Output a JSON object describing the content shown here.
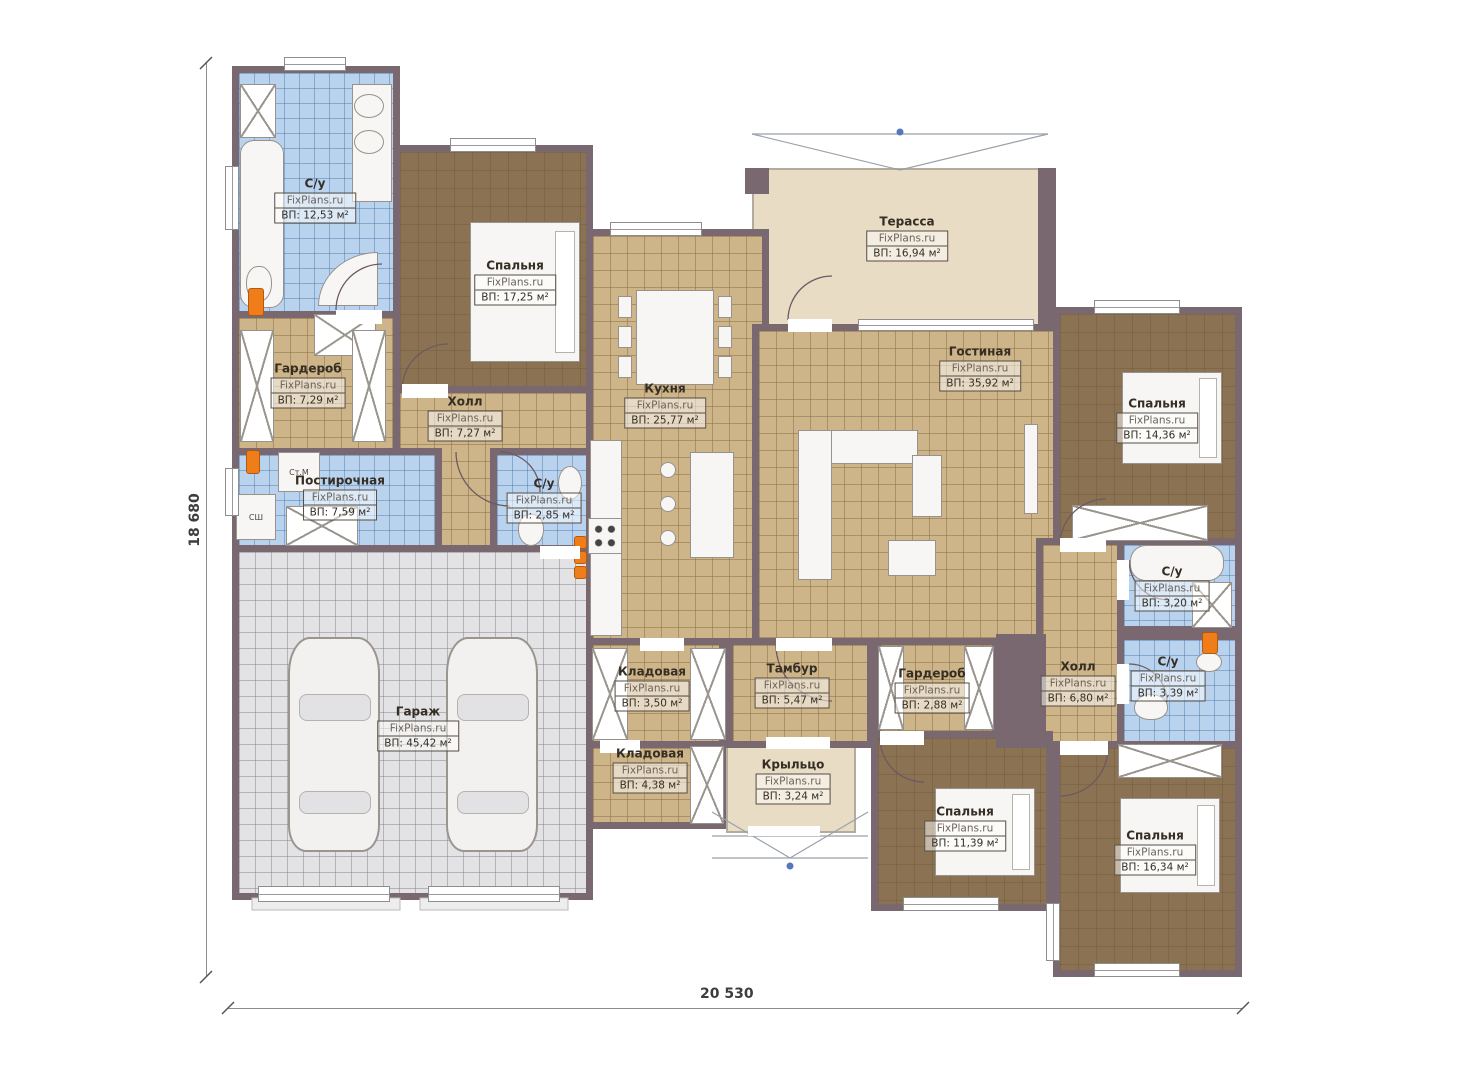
{
  "plan": {
    "watermark": "FixPlans.ru",
    "dimensions": {
      "height": "18 680",
      "width": "20 530"
    },
    "appliances": {
      "washer": "Ст.М",
      "dryer": "СШ"
    },
    "rooms": [
      {
        "id": "bathroom-master",
        "name": "С/у",
        "area": "ВП: 12,53 м²"
      },
      {
        "id": "bedroom-master",
        "name": "Спальня",
        "area": "ВП: 17,25 м²"
      },
      {
        "id": "wardrobe-left",
        "name": "Гардероб",
        "area": "ВП: 7,29 м²"
      },
      {
        "id": "hall-left",
        "name": "Холл",
        "area": "ВП: 7,27 м²"
      },
      {
        "id": "laundry",
        "name": "Постирочная",
        "area": "ВП: 7,59 м²"
      },
      {
        "id": "bathroom-small",
        "name": "С/у",
        "area": "ВП: 2,85 м²"
      },
      {
        "id": "garage",
        "name": "Гараж",
        "area": "ВП: 45,42 м²"
      },
      {
        "id": "kitchen",
        "name": "Кухня",
        "area": "ВП: 25,77 м²"
      },
      {
        "id": "terrace",
        "name": "Терасса",
        "area": "ВП: 16,94 м²"
      },
      {
        "id": "living-room",
        "name": "Гостиная",
        "area": "ВП: 35,92 м²"
      },
      {
        "id": "bedroom-right",
        "name": "Спальня",
        "area": "ВП: 14,36 м²"
      },
      {
        "id": "bathroom-right",
        "name": "С/у",
        "area": "ВП: 3,20 м²"
      },
      {
        "id": "hall-right",
        "name": "Холл",
        "area": "ВП: 6,80 м²"
      },
      {
        "id": "bathroom-right-small",
        "name": "С/у",
        "area": "ВП: 3,39 м²"
      },
      {
        "id": "pantry-top",
        "name": "Кладовая",
        "area": "ВП: 3,50 м²"
      },
      {
        "id": "tambour",
        "name": "Тамбур",
        "area": "ВП: 5,47 м²"
      },
      {
        "id": "wardrobe-bottom",
        "name": "Гардероб",
        "area": "ВП: 2,88 м²"
      },
      {
        "id": "pantry-bottom",
        "name": "Кладовая",
        "area": "ВП: 4,38 м²"
      },
      {
        "id": "porch",
        "name": "Крыльцо",
        "area": "ВП: 3,24 м²"
      },
      {
        "id": "bedroom-bottom-middle",
        "name": "Спальня",
        "area": "ВП: 11,39 м²"
      },
      {
        "id": "bedroom-bottom-right",
        "name": "Спальня",
        "area": "ВП: 16,34 м²"
      }
    ],
    "colors": {
      "wall": "#7a6870",
      "floor_tile": "#cdb489",
      "floor_wood": "#8b7252",
      "floor_bath": "#b9d3ef",
      "floor_terrace": "#e9dcc5",
      "floor_garage": "#e3e3e5",
      "accent_boiler": "#ef7d1a"
    }
  }
}
